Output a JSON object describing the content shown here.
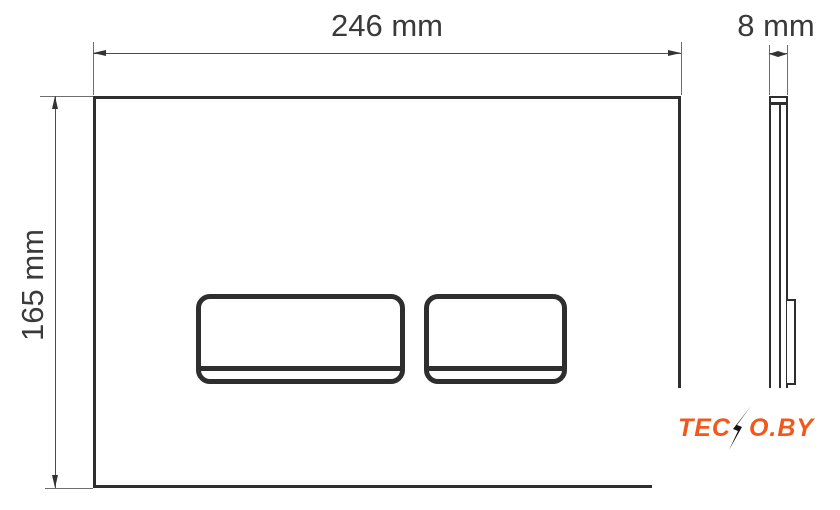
{
  "dimensions": {
    "width": {
      "label": "246 mm"
    },
    "height": {
      "label": "165 mm"
    },
    "depth": {
      "label": "8 mm"
    }
  },
  "watermark": {
    "prefix": "TEC",
    "suffix": "O.BY",
    "full_text": "TECNO.BY",
    "text_color": "#f2581c",
    "bolt_color": "#141414"
  },
  "colors": {
    "outline": "#2e2e2e",
    "dimension_lines": "#4d4d4d",
    "label_text": "#3a3a3a",
    "background": "#ffffff"
  }
}
